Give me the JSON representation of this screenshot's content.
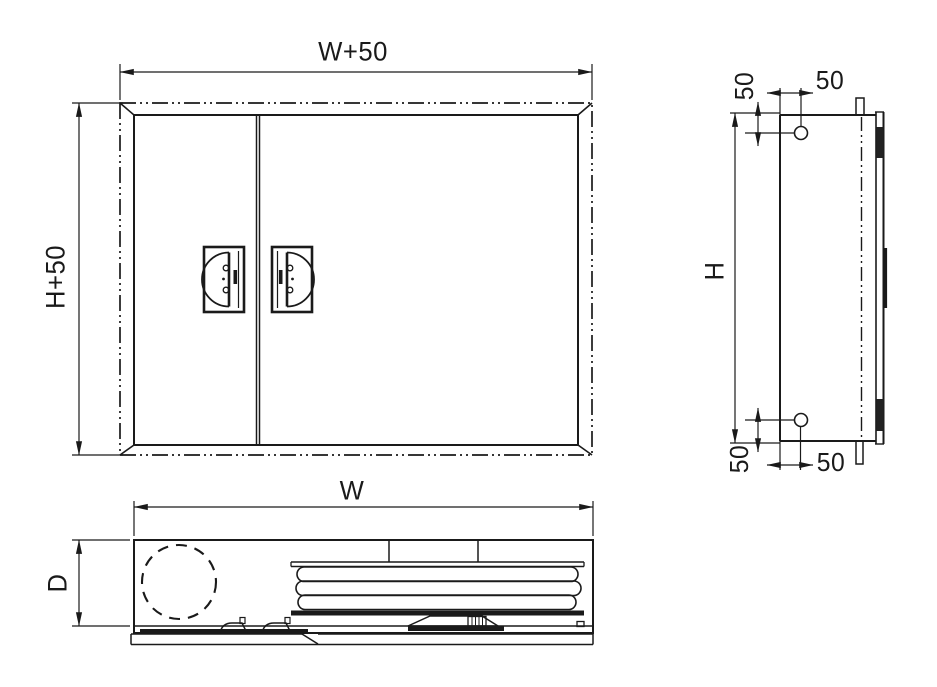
{
  "drawing": {
    "title_hint": "cabinet three-view technical drawing",
    "front_view": {
      "width_dim": "W+50",
      "height_dim": "H+50"
    },
    "side_view": {
      "height_dim": "H",
      "hole_offset_top_vertical": "50",
      "hole_offset_top_horizontal": "50",
      "hole_offset_bottom_vertical": "50",
      "hole_offset_bottom_horizontal": "50"
    },
    "bottom_view": {
      "width_dim": "W",
      "depth_dim": "D"
    }
  },
  "colors": {
    "ink": "#1a1a1a",
    "paper": "#ffffff"
  }
}
